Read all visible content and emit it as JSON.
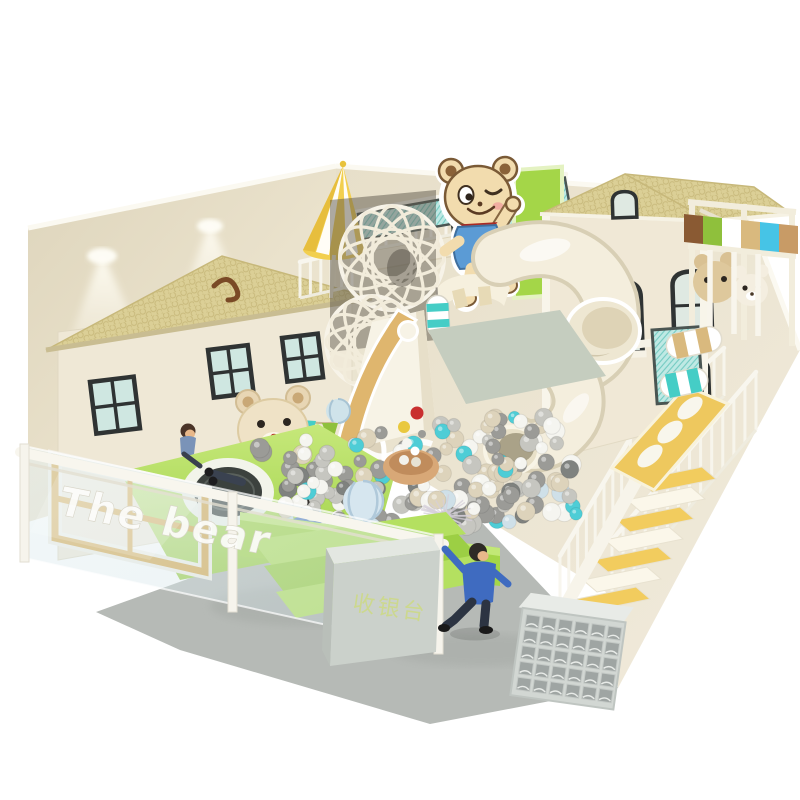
{
  "meta": {
    "description": "3D render of a bear-themed indoor soft playground with ball pit, spiral tube slide, playhouses, trampoline and staircase, on a white background"
  },
  "signage": {
    "glass_fence_text": "The bear",
    "cashier_counter_text": "收银台"
  },
  "figures": {
    "children_count": 4
  },
  "objects": [
    "left-playhouse",
    "right-playhouse",
    "bear-mascot-cutout",
    "striped-umbrella",
    "wicker-ball-climbers",
    "spiral-tube-slide",
    "wide-slide",
    "ball-pit",
    "ball-fountain-tub",
    "trampoline",
    "glass-fence",
    "cashier-counter",
    "staircase",
    "climb-ramp",
    "squeeze-rollers",
    "shoe-cubby-shelf",
    "bunting-flags"
  ],
  "palette": {
    "wall_cream": "#e9e1cb",
    "wall_light": "#f0ead9",
    "wall_rim": "#fbf9f1",
    "roof_tan": "#dbcf96",
    "roof_line": "#c7b87a",
    "facade_cream": "#efe8d6",
    "lime_green": "#a4d648",
    "lime_light": "#c2e876",
    "teal_mesh": "#bfe9e4",
    "teal": "#45cdc6",
    "sky_blue": "#46c4e6",
    "awning_brown": "#8a5a33",
    "awning_green": "#8fc03c",
    "stripe_tan": "#d9b97e",
    "slide_cream": "#f4eedd",
    "slide_edge": "#d8cfb5",
    "tub_tan": "#d8a877",
    "ball_red": "#c92f2f",
    "ball_yellow": "#e9c83e",
    "stair_yellow": "#f2cc5e",
    "kid_jacket_blue": "#3f6bc0",
    "kid_hoodie_blue": "#5d82c4",
    "counter_gray": "#cbd1cb",
    "counter_text_green": "#ccd88e",
    "floor_gray": "#b6bab6",
    "glass_tint": "#d7e9ee",
    "frame_gold": "#d8a94e",
    "bear_fur": "#f2dcae",
    "bear_outline": "#7a5a36",
    "mascot_shirt": "#5b9bd5",
    "mascot_scarf": "#c9382f"
  },
  "ball_pit": {
    "count": 185,
    "radius_min": 6,
    "radius_max": 10,
    "colors": [
      "#f5f5f0",
      "#ddd3bb",
      "#c6c6c0",
      "#9b9b97",
      "#7f827f",
      "#4ecdd6",
      "#cfe0e8"
    ],
    "weights": [
      0.27,
      0.17,
      0.22,
      0.19,
      0.04,
      0.06,
      0.05
    ]
  }
}
